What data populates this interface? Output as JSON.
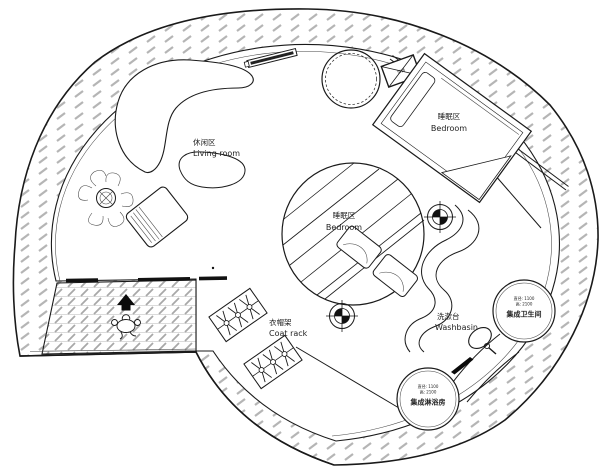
{
  "title": "Circular cabin floor plan",
  "colors": {
    "line": "#1a1a1a",
    "hatch_gray": "#b5b5b5",
    "floor_hatch_gray": "#a8a8a8",
    "background": "#ffffff"
  },
  "labels": {
    "living": {
      "zh": "休闲区",
      "en": "Living room"
    },
    "bedroom_upper": {
      "zh": "睡眠区",
      "en": "Bedroom"
    },
    "bedroom_center": {
      "zh": "睡眠区",
      "en": "Bedroom"
    },
    "coat_rack": {
      "zh": "衣帽架",
      "en": "Coat rack"
    },
    "washbasin": {
      "zh": "洗漱台",
      "en": "Washbasin"
    },
    "ac_unit": {
      "zh": "空调"
    }
  },
  "pods": {
    "toilet": {
      "name": "集成卫生间",
      "spec_diameter": "直径: 1100",
      "spec_height": "高: 2100"
    },
    "shower": {
      "name": "集成淋浴房",
      "spec_diameter": "直径: 1100",
      "spec_height": "高: 2100"
    }
  },
  "icons": {
    "entrance_arrow": "solid black arrow pointing into the house",
    "entrance_person": "top-view person figure at entry walkway",
    "column_marker": "crosshair survey/center mark (2 places)",
    "ac_unit": "rectangle with X (air conditioner)",
    "sink": "oval basin with faucet on vanity counter",
    "potted_plant": "round pot with leaf cluster"
  }
}
